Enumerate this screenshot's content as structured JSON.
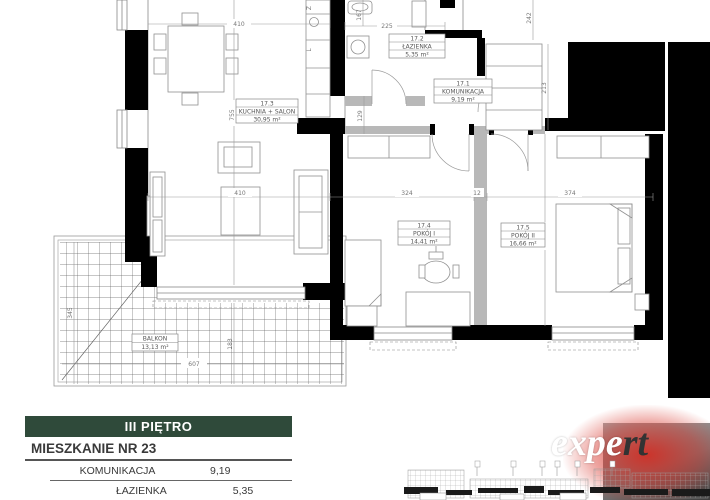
{
  "plan": {
    "rooms": [
      {
        "id": "17.3",
        "name": "KUCHNIA + SALON",
        "area": "30,95 m²"
      },
      {
        "id": "17.2",
        "name": "ŁAZIENKA",
        "area": "5,35 m²"
      },
      {
        "id": "17.1",
        "name": "KOMUNIKACJA",
        "area": "9,19 m²"
      },
      {
        "id": "17.4",
        "name": "POKÓJ I",
        "area": "14,41 m²"
      },
      {
        "id": "17.5",
        "name": "POKÓJ II",
        "area": "16,66 m²"
      }
    ],
    "balcony": {
      "name": "BALKON",
      "area": "13,13 m²"
    },
    "kitchen_fixture_labels": {
      "sink": "Z",
      "fridge": "L"
    },
    "dims": {
      "salon_width_top": "410",
      "bath_width": "225",
      "bath_side": "167",
      "entry_side": "242",
      "salon_height": "755",
      "salon_width_mid": "410",
      "room1_width": "324",
      "partition": "12",
      "room2_width": "374",
      "wardrobe": "213",
      "corridor": "129",
      "balcony_depth": "345",
      "balcony_width": "607",
      "balcony_inner": "183",
      "room2_height": "445"
    }
  },
  "legend": {
    "floor": "III PIĘTRO",
    "apartment": "MIESZKANIE NR 23",
    "rows": [
      {
        "label": "KOMUNIKACJA",
        "value": "9,19"
      },
      {
        "label": "ŁAZIENKA",
        "value": "5,35"
      }
    ]
  },
  "logo": {
    "white": "expe",
    "dark": "rt"
  },
  "colors": {
    "wall": "#000000",
    "legend_green": "#2f4a3a",
    "logo_red": "#d6281e"
  }
}
